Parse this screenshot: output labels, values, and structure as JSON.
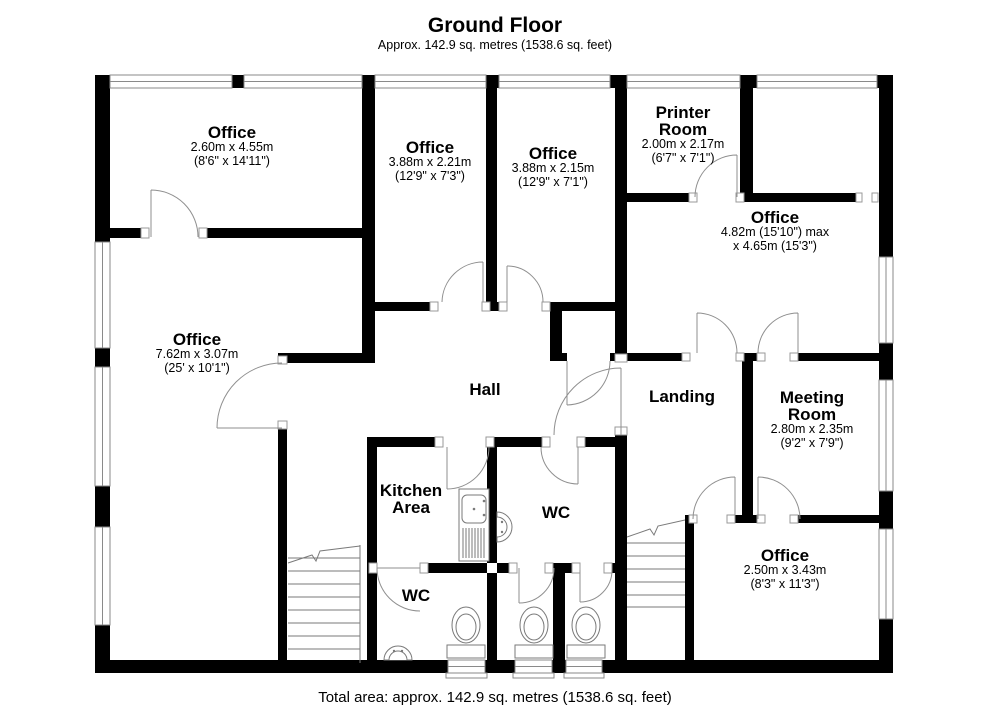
{
  "title": {
    "main": "Ground Floor",
    "subtitle": "Approx. 142.9 sq. metres (1538.6 sq. feet)"
  },
  "footer": {
    "total_area": "Total area: approx. 142.9 sq. metres (1538.6 sq. feet)"
  },
  "colors": {
    "wall": "#000000",
    "thin_line": "#8a8a8a",
    "background": "#ffffff"
  },
  "rooms": [
    {
      "name": "Office",
      "dim_metric": "2.60m x 4.55m",
      "dim_imperial": "(8'6\" x 14'11\")"
    },
    {
      "name": "Office",
      "dim_metric": "3.88m x 2.21m",
      "dim_imperial": "(12'9\" x 7'3\")"
    },
    {
      "name": "Office",
      "dim_metric": "3.88m x 2.15m",
      "dim_imperial": "(12'9\" x 7'1\")"
    },
    {
      "name": "Printer Room",
      "dim_metric": "2.00m x 2.17m",
      "dim_imperial": "(6'7\" x 7'1\")"
    },
    {
      "name": "Office",
      "dim_metric": "4.82m (15'10\") max",
      "dim_imperial": "x 4.65m (15'3\")"
    },
    {
      "name": "Office",
      "dim_metric": "7.62m x 3.07m",
      "dim_imperial": "(25' x 10'1\")"
    },
    {
      "name": "Hall"
    },
    {
      "name": "Landing"
    },
    {
      "name": "Meeting Room",
      "dim_metric": "2.80m x 2.35m",
      "dim_imperial": "(9'2\" x 7'9\")"
    },
    {
      "name": "Kitchen Area"
    },
    {
      "name": "WC"
    },
    {
      "name": "WC"
    },
    {
      "name": "Office",
      "dim_metric": "2.50m x 3.43m",
      "dim_imperial": "(8'3\" x 11'3\")"
    }
  ]
}
